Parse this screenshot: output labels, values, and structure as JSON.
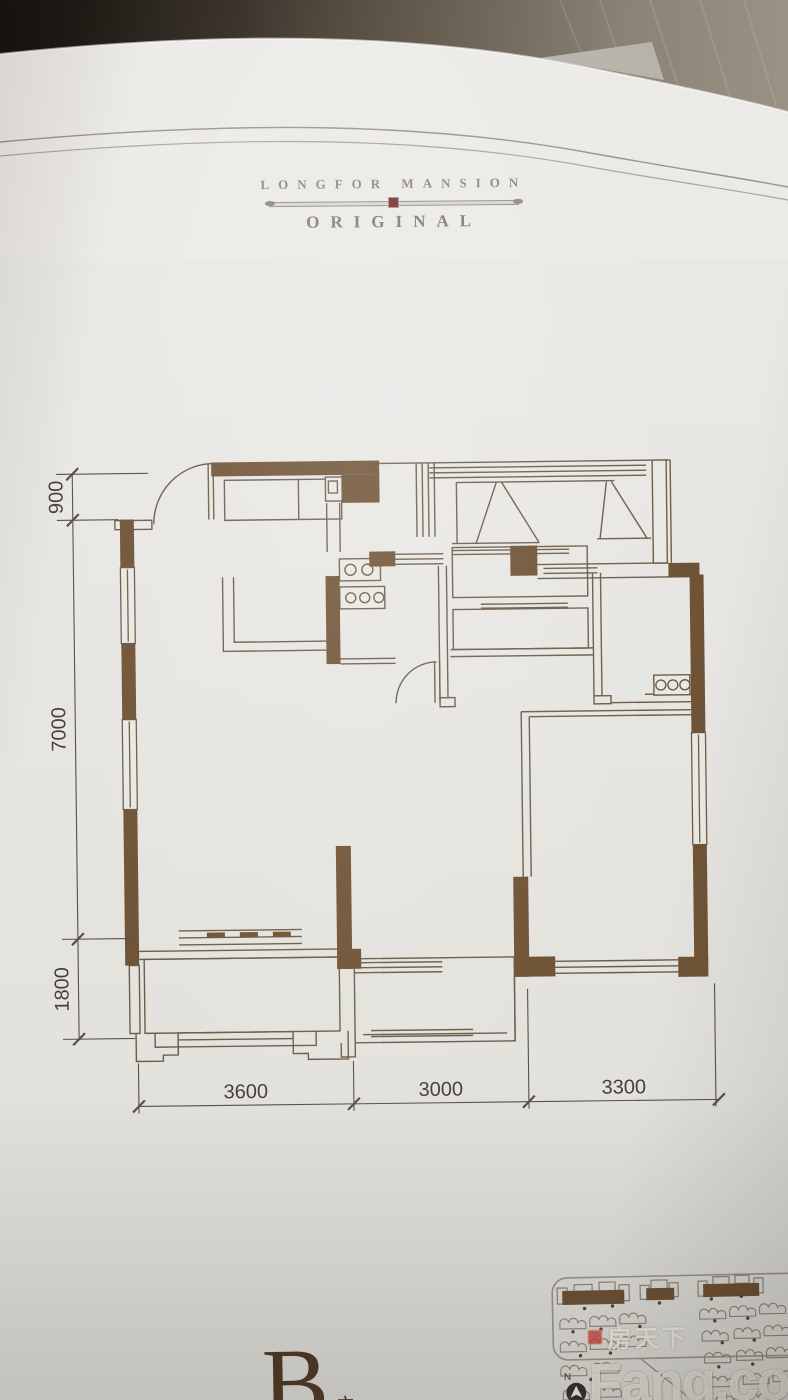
{
  "page": {
    "brand": {
      "line1": "LONGFOR MANSION",
      "line2": "ORIGINAL",
      "accent_color": "#7d2e2a"
    },
    "floor_plan": {
      "wall_color": "#6f5336",
      "dimensions_left": [
        {
          "label": "900"
        },
        {
          "label": "7000"
        },
        {
          "label": "1800"
        }
      ],
      "dimensions_bottom": [
        {
          "label": "3600"
        },
        {
          "label": "3000"
        },
        {
          "label": "3300"
        }
      ]
    },
    "unit": {
      "letter": "B",
      "suffix": "户型"
    },
    "site_plan": {
      "compass_label": "N"
    },
    "watermark": {
      "cn": "房天下",
      "en": "Fang.com"
    }
  }
}
